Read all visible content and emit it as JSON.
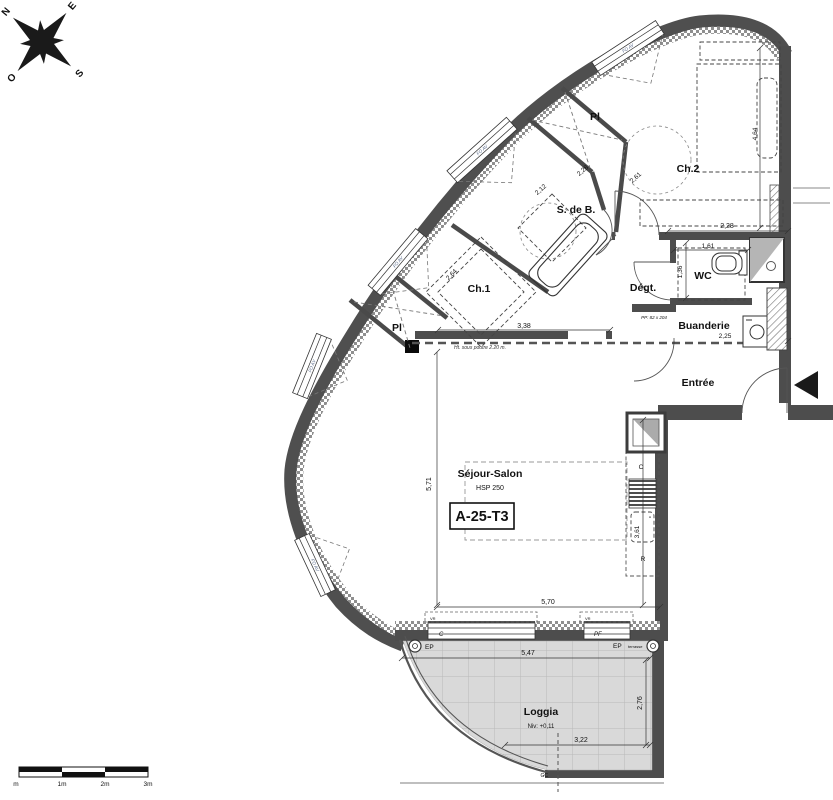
{
  "compass": {
    "n": "N",
    "e": "E",
    "s": "S",
    "o": "O"
  },
  "scale_bar": {
    "labels": [
      "m",
      "1m",
      "2m",
      "3m"
    ]
  },
  "unit": {
    "code": "A-25-T3"
  },
  "rooms": {
    "sejour": {
      "name": "Séjour-Salon",
      "height": "HSP 250"
    },
    "ch1": {
      "name": "Ch.1"
    },
    "ch2": {
      "name": "Ch.2"
    },
    "sdb": {
      "name": "S. de B."
    },
    "wc": {
      "name": "WC"
    },
    "degt": {
      "name": "Dégt."
    },
    "buanderie": {
      "name": "Buanderie"
    },
    "entree": {
      "name": "Entrée"
    },
    "loggia": {
      "name": "Loggia",
      "level": "Niv: +0,11"
    },
    "pl_upper": {
      "name": "Pl"
    },
    "pl_lower": {
      "name": "Pl"
    }
  },
  "dimensions": {
    "sejour_h": "5,71",
    "sejour_w": "5,70",
    "ch1_w": "3,38",
    "ch1_diag": "2,64",
    "ch2_w": "2,28",
    "ch2_h": "4,64",
    "ch2_left": "2,61",
    "sdb_a": "2,28",
    "sdb_b": "2,12",
    "wc_w": "1,61",
    "wc_h": "1,36",
    "buanderie_w": "2,25",
    "kitchen_h": "3,61",
    "loggia_w": "5,47",
    "loggia_inner": "3,22",
    "loggia_h": "2,76"
  },
  "annotations": {
    "beam": "Ht. sous poutre 2.20 m.",
    "door_size": "PP: 82 x 204",
    "gc": "GC",
    "ep": "EP",
    "terrasse": "terrasse"
  },
  "windows": {
    "fo_av": "FO AV",
    "c": "C",
    "pf": "PF",
    "vr": "VR"
  },
  "kitchen": {
    "c": "C",
    "r": "R",
    "mark": "\""
  }
}
